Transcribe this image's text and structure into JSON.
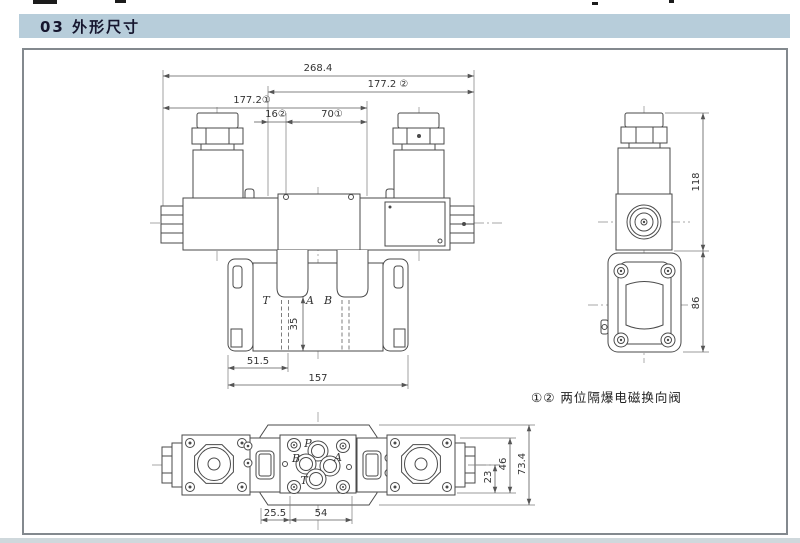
{
  "page": {
    "section_title": "03 外形尺寸",
    "note": "①② 两位隔爆电磁换向阀"
  },
  "front_view": {
    "dims": {
      "overall": "268.4",
      "w2": "177.2 ②",
      "w1": "177.2①",
      "d16": "16②",
      "d70": "70①",
      "d35": "35",
      "d51": "51.5",
      "d157": "157"
    },
    "ports": {
      "t": "T",
      "a": "A",
      "b": "B"
    }
  },
  "side_view": {
    "dims": {
      "h118": "118",
      "h86": "86"
    }
  },
  "top_view": {
    "ports": {
      "p": "P",
      "a": "A",
      "b": "B",
      "t": "T"
    },
    "dims": {
      "d25": "25.5",
      "d54": "54",
      "d23": "23",
      "d46": "46",
      "d73": "73.4"
    }
  },
  "colors": {
    "header_bg": "#b7cdda",
    "header_text": "#16162e",
    "drawing_line": "#4a4a4a",
    "frame_border": "#83898e"
  }
}
